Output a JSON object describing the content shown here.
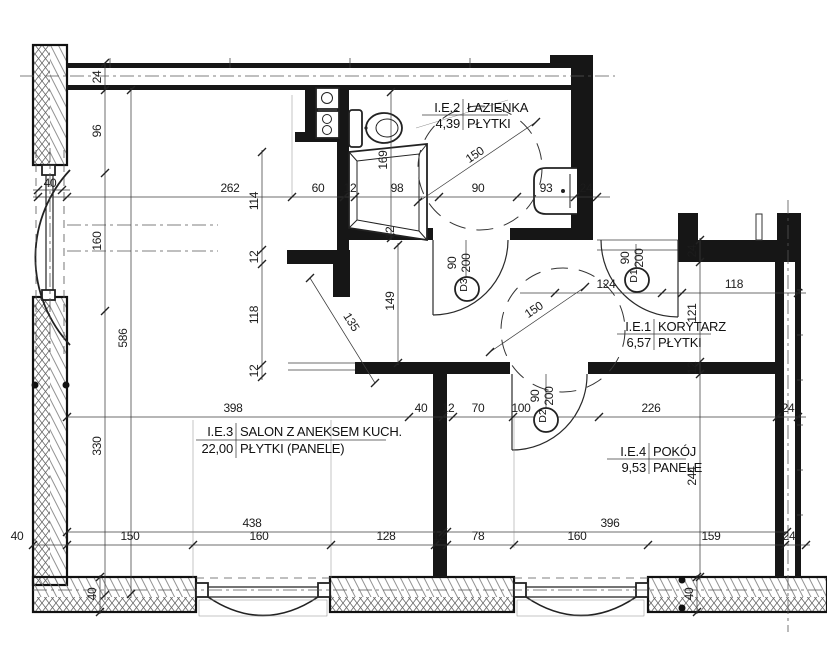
{
  "plan": {
    "rooms": [
      {
        "id": "I.E.2",
        "name": "ŁAZIENKA",
        "area": "4,39",
        "floor": "PŁYTKI"
      },
      {
        "id": "I.E.1",
        "name": "KORYTARZ",
        "area": "6,57",
        "floor": "PŁYTKI"
      },
      {
        "id": "I.E.3",
        "name": "SALON Z ANEKSEM KUCH.",
        "area": "22,00",
        "floor": "PŁYTKI (PANELE)"
      },
      {
        "id": "I.E.4",
        "name": "POKÓJ",
        "area": "9,53",
        "floor": "PANELE"
      }
    ],
    "doors": [
      {
        "tag": "D1",
        "width": "90",
        "height": "200"
      },
      {
        "tag": "D2",
        "width": "90",
        "height": "200"
      },
      {
        "tag": "D3",
        "width": "90",
        "height": "200"
      }
    ],
    "dims": {
      "top_chain": [
        "40",
        "262",
        "60",
        "12",
        "98",
        "90",
        "93",
        "24"
      ],
      "entry_chain": [
        "124",
        "118"
      ],
      "mid_chain": [
        "398",
        "40",
        "12",
        "70",
        "100",
        "226",
        "24"
      ],
      "bottom_overall": [
        "438",
        "396"
      ],
      "bottom_chain": [
        "40",
        "150",
        "160",
        "128",
        "12",
        "78",
        "160",
        "159",
        "24"
      ],
      "left_chain": [
        "24",
        "96",
        "160",
        "330",
        "586"
      ],
      "mid_vert": [
        "114",
        "12",
        "118",
        "12",
        "169",
        "12",
        "149"
      ],
      "right_vert": [
        "24",
        "121",
        "12",
        "244"
      ],
      "wall_thk": [
        "40",
        "40"
      ],
      "diag": [
        "135",
        "150",
        "150"
      ]
    }
  }
}
